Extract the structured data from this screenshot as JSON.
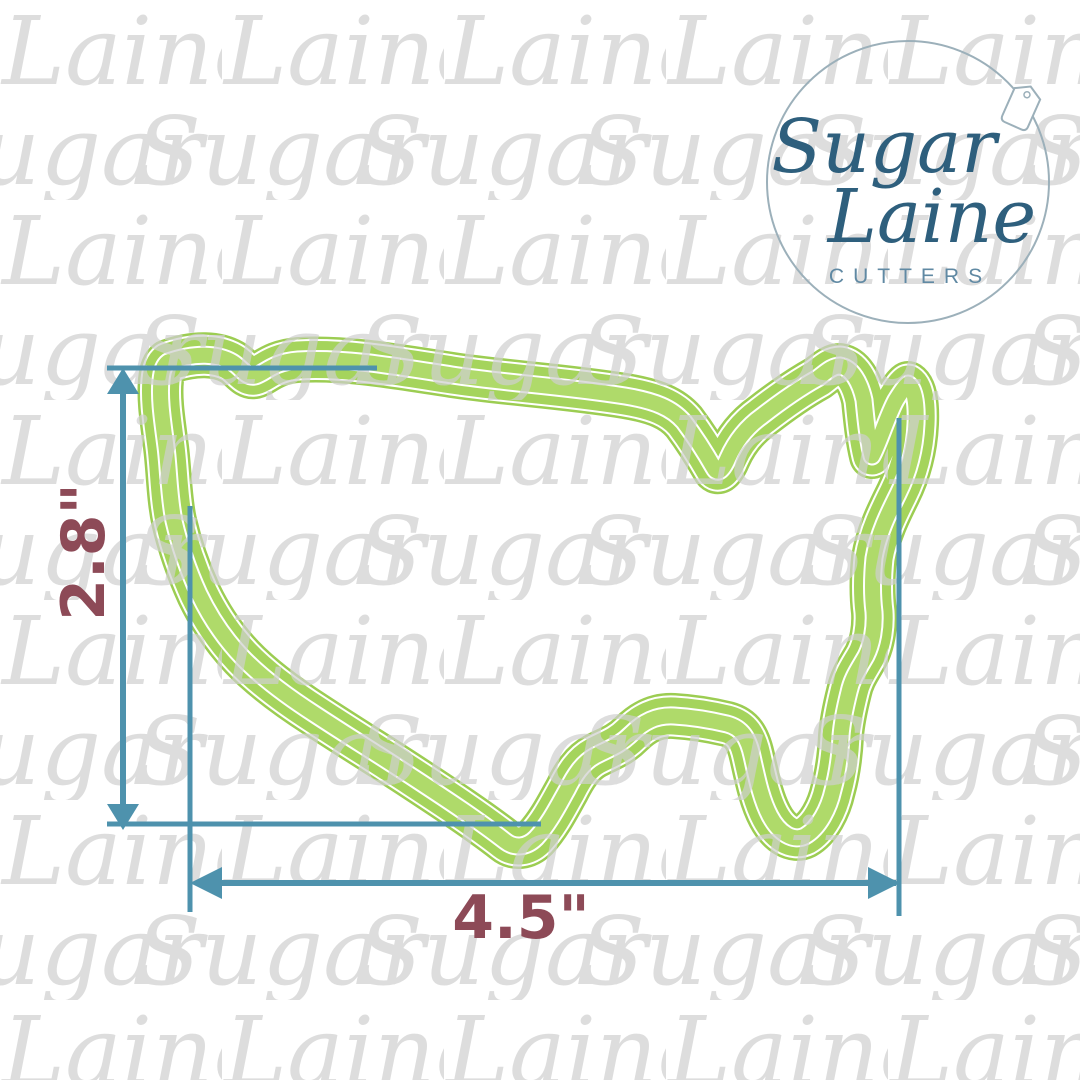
{
  "colors": {
    "teal": "#4e92ad",
    "maroon": "#8d4a57",
    "green": "#a5d45c",
    "green_dark": "#9ccd52",
    "green_light": "#afda6a",
    "watermark_gray": "#cfcfcf",
    "logo_ink": "#2e5f7d",
    "logo_sub": "#6089a3",
    "logo_ring": "#9cb0ba"
  },
  "watermark": {
    "word_a": "Laine",
    "word_b": "Sugar"
  },
  "logo": {
    "script_top": "Sugar",
    "script_bottom": "Laine",
    "subtitle": "CUTTERS",
    "icon": "price-tag-icon"
  },
  "product": {
    "shape_name": "usa-cookie-cutter-outline"
  },
  "dimensions": {
    "height_label": "2.8\"",
    "width_label": "4.5\""
  }
}
